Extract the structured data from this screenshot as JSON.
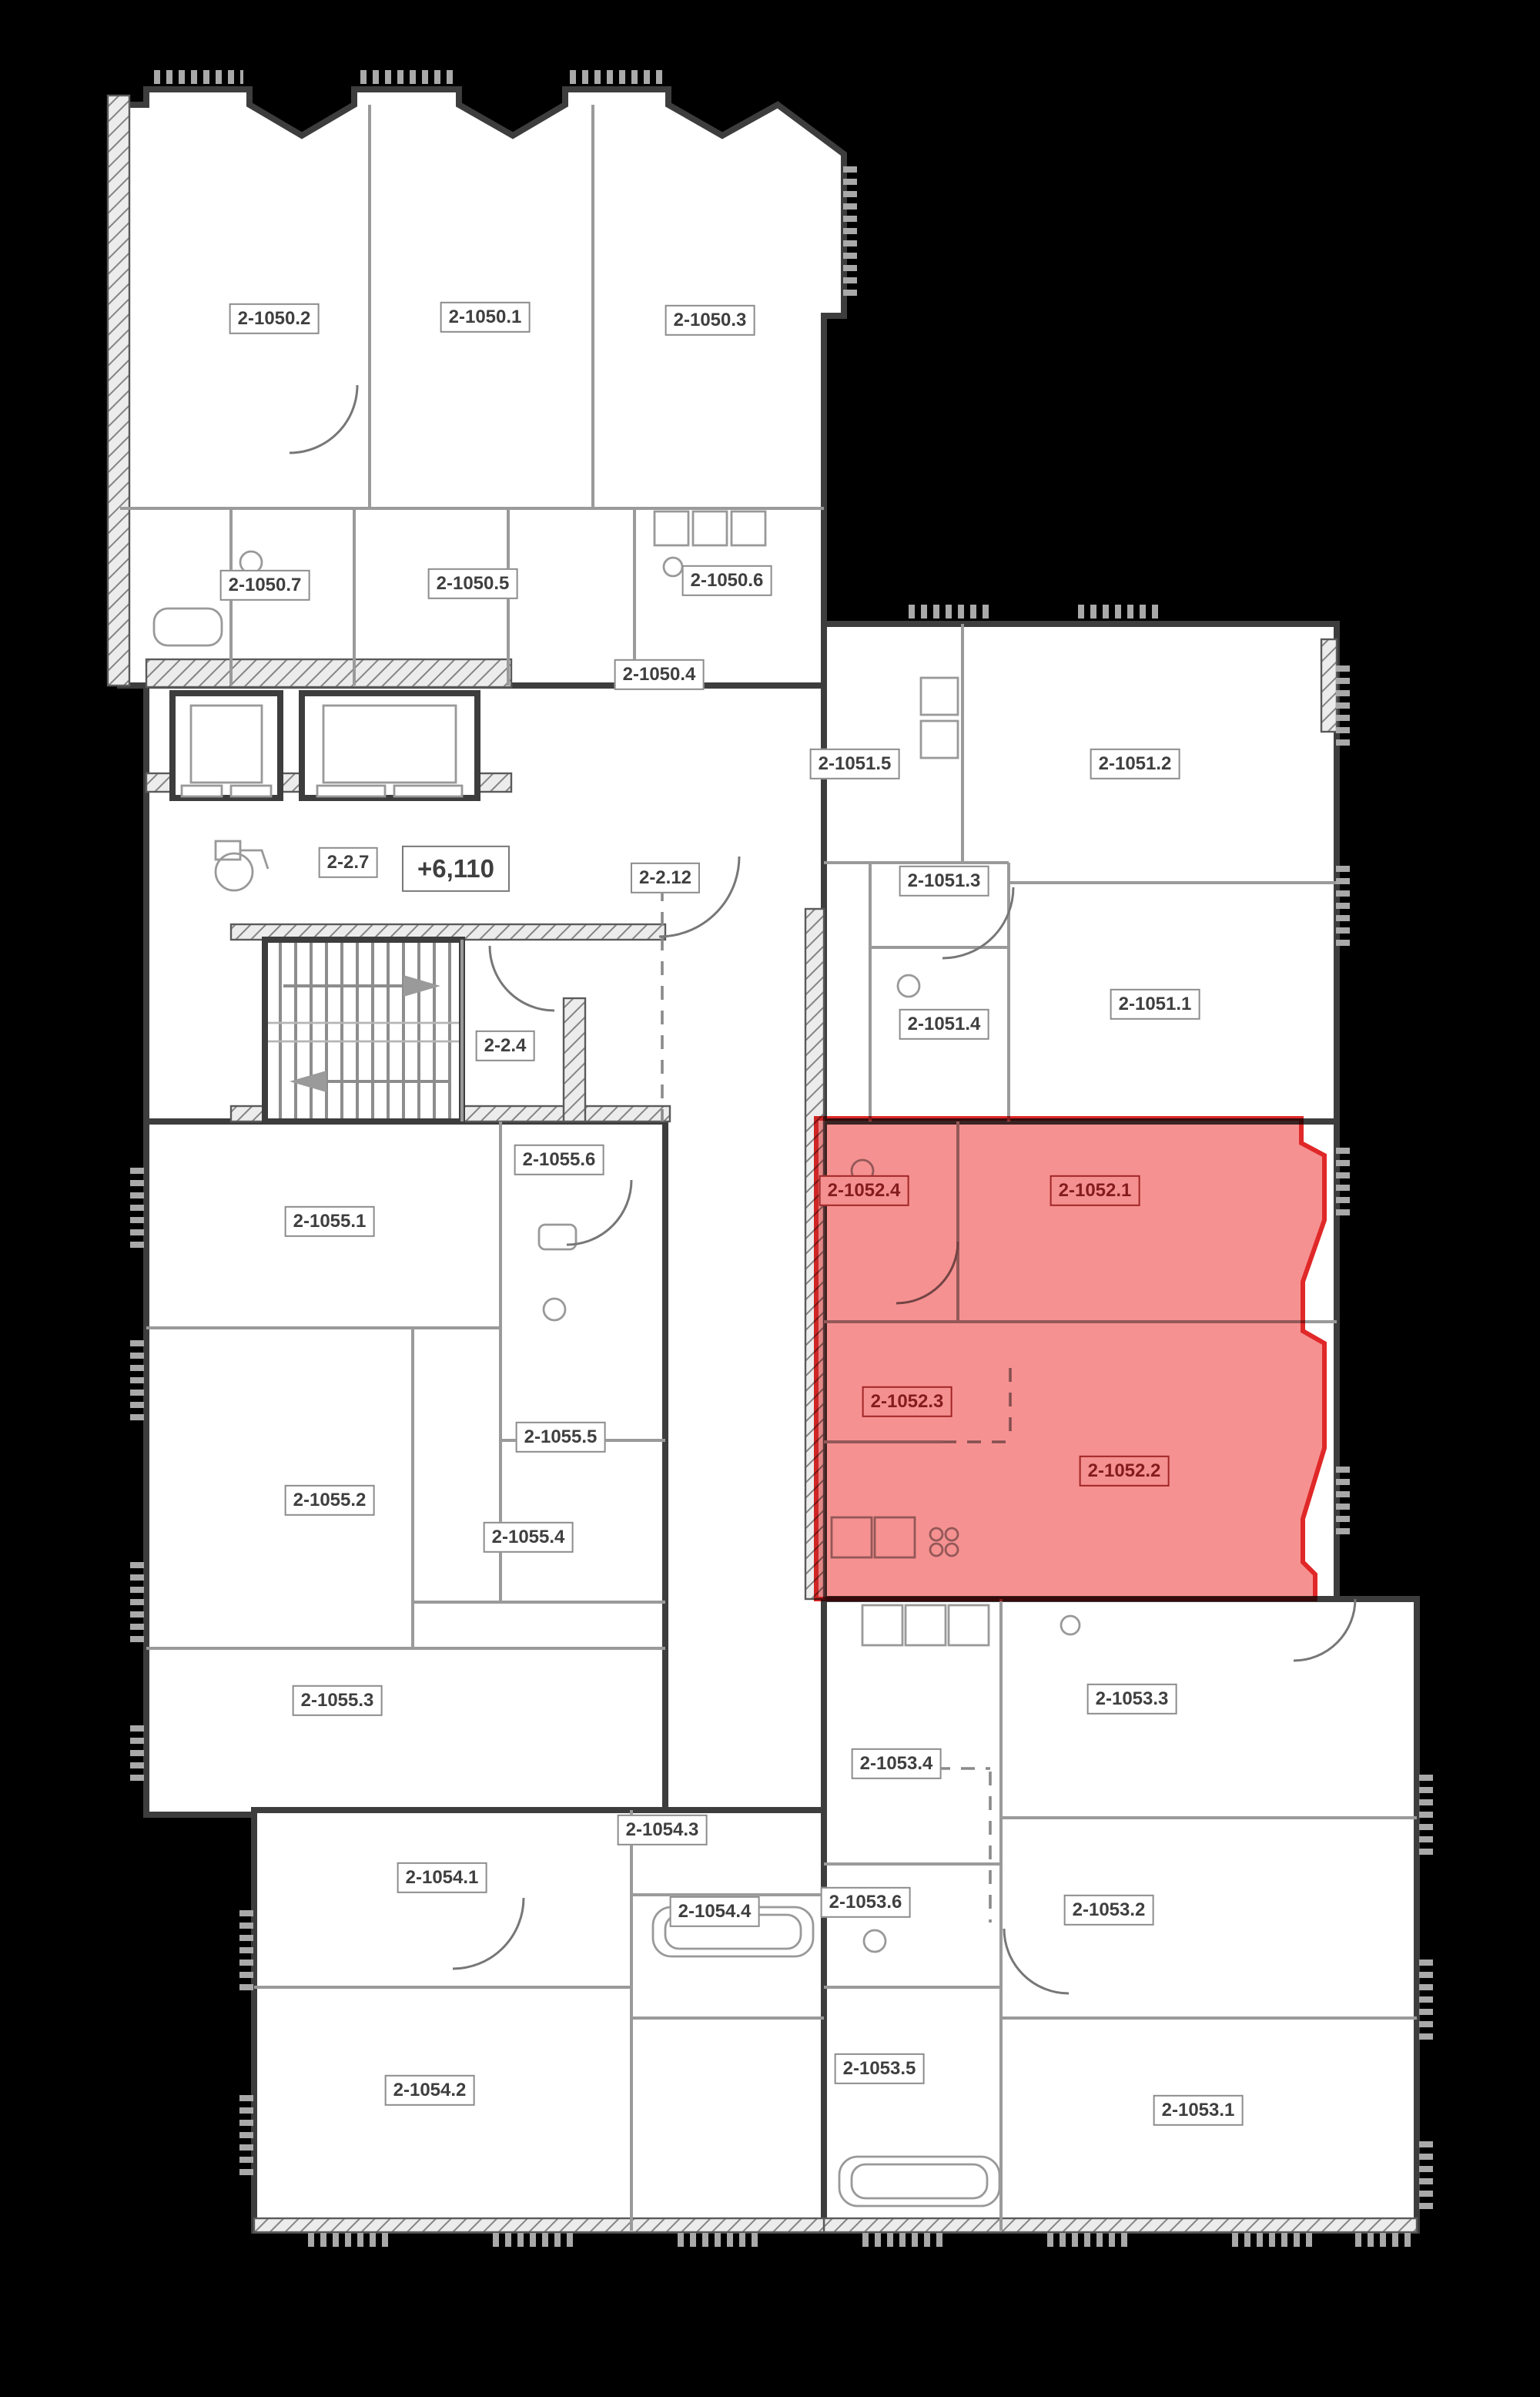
{
  "plan": {
    "type": "residential-floor-plan",
    "background": "#000000",
    "floor_fill": "#ffffff",
    "wall_color": "#3d3d3d",
    "partition_color": "#9a9a9a",
    "highlight_fill": "#f57e7e",
    "highlight_stroke": "#e02828",
    "highlighted_unit_labels": [
      "2-1052.4",
      "2-1052.1",
      "2-1052.3",
      "2-1052.2"
    ],
    "level_mark": "+6,110"
  },
  "labels": [
    {
      "text": "2-1050.2",
      "zone": "apartment"
    },
    {
      "text": "2-1050.1",
      "zone": "apartment"
    },
    {
      "text": "2-1050.3",
      "zone": "apartment"
    },
    {
      "text": "2-1050.7",
      "zone": "apartment"
    },
    {
      "text": "2-1050.5",
      "zone": "apartment"
    },
    {
      "text": "2-1050.6",
      "zone": "apartment"
    },
    {
      "text": "2-1050.4",
      "zone": "apartment"
    },
    {
      "text": "2-1051.5",
      "zone": "apartment"
    },
    {
      "text": "2-1051.2",
      "zone": "apartment"
    },
    {
      "text": "2-1051.3",
      "zone": "apartment"
    },
    {
      "text": "2-1051.4",
      "zone": "apartment"
    },
    {
      "text": "2-1051.1",
      "zone": "apartment"
    },
    {
      "text": "2-2.7",
      "zone": "common"
    },
    {
      "text": "+6,110",
      "zone": "level"
    },
    {
      "text": "2-2.12",
      "zone": "common"
    },
    {
      "text": "2-2.4",
      "zone": "common"
    },
    {
      "text": "2-1055.6",
      "zone": "apartment"
    },
    {
      "text": "2-1055.1",
      "zone": "apartment"
    },
    {
      "text": "2-1052.4",
      "zone": "highlighted"
    },
    {
      "text": "2-1052.1",
      "zone": "highlighted"
    },
    {
      "text": "2-1052.3",
      "zone": "highlighted"
    },
    {
      "text": "2-1052.2",
      "zone": "highlighted"
    },
    {
      "text": "2-1055.5",
      "zone": "apartment"
    },
    {
      "text": "2-1055.2",
      "zone": "apartment"
    },
    {
      "text": "2-1055.4",
      "zone": "apartment"
    },
    {
      "text": "2-1055.3",
      "zone": "apartment"
    },
    {
      "text": "2-1053.3",
      "zone": "apartment"
    },
    {
      "text": "2-1053.4",
      "zone": "apartment"
    },
    {
      "text": "2-1054.3",
      "zone": "apartment"
    },
    {
      "text": "2-1054.1",
      "zone": "apartment"
    },
    {
      "text": "2-1054.4",
      "zone": "apartment"
    },
    {
      "text": "2-1053.6",
      "zone": "apartment"
    },
    {
      "text": "2-1053.2",
      "zone": "apartment"
    },
    {
      "text": "2-1053.5",
      "zone": "apartment"
    },
    {
      "text": "2-1054.2",
      "zone": "apartment"
    },
    {
      "text": "2-1053.1",
      "zone": "apartment"
    }
  ]
}
